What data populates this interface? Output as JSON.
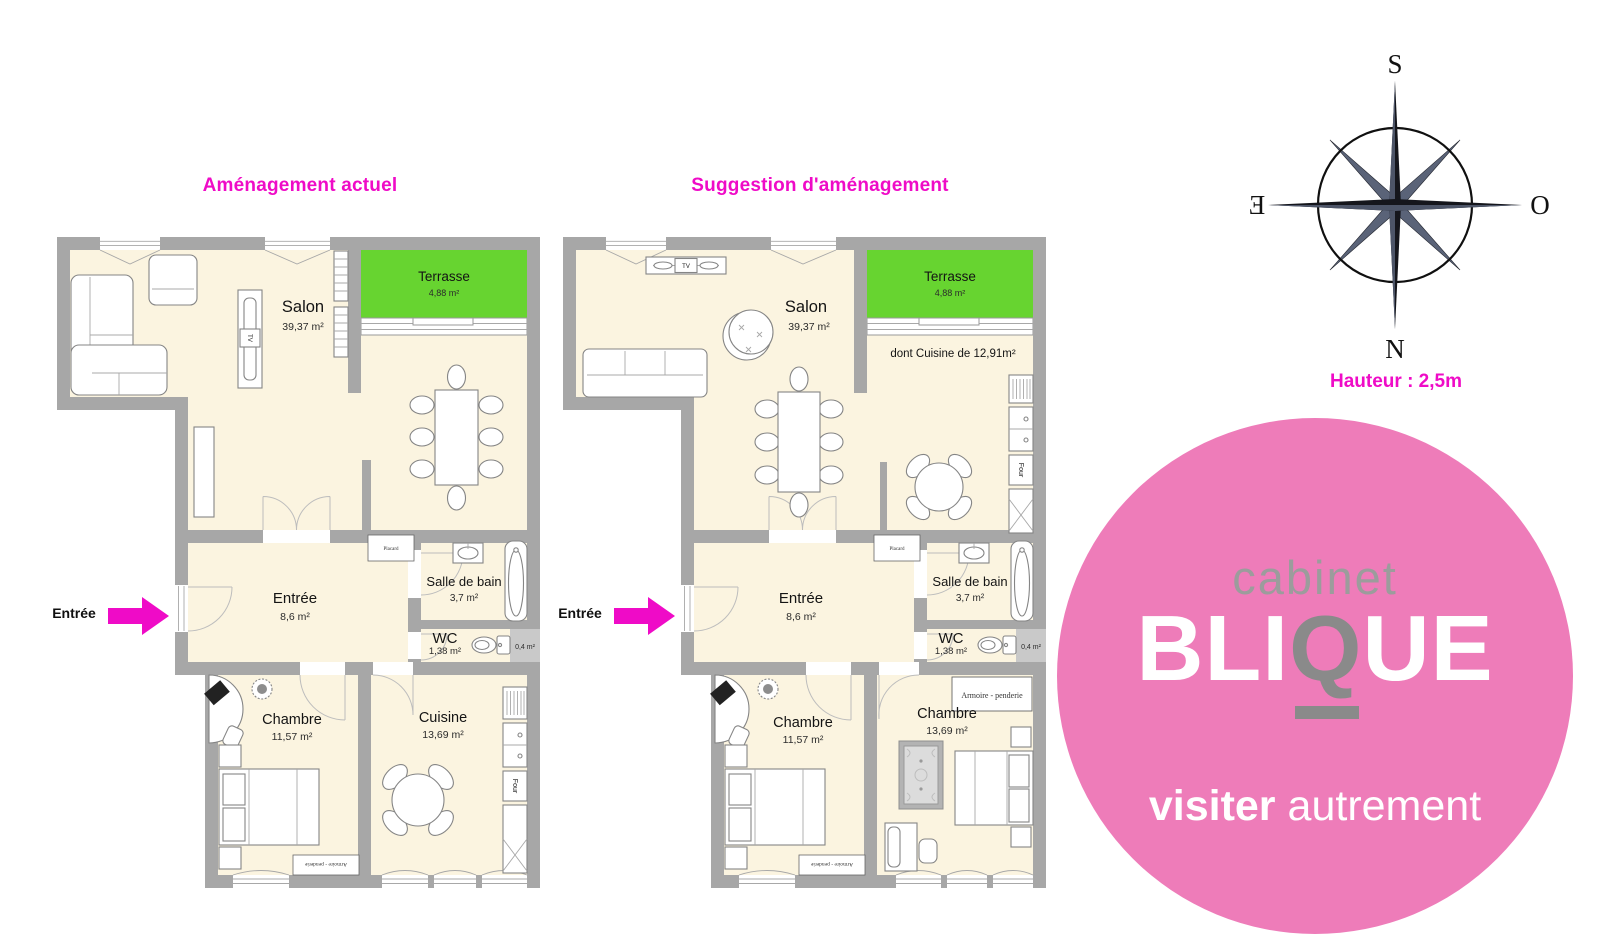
{
  "titles": {
    "left": "Aménagement actuel",
    "right": "Suggestion d'aménagement"
  },
  "entry_label": "Entrée",
  "plans": {
    "left": {
      "salon": {
        "name": "Salon",
        "area": "39,37 m²"
      },
      "terrasse": {
        "name": "Terrasse",
        "area": "4,88 m²"
      },
      "entree": {
        "name": "Entrée",
        "area": "8,6 m²"
      },
      "salle_de_bain": {
        "name": "Salle de bain",
        "area": "3,7 m²"
      },
      "wc": {
        "name": "WC",
        "area": "1,38 m²"
      },
      "closet_area": "0,4 m²",
      "placard": "Placard",
      "chambre": {
        "name": "Chambre",
        "area": "11,57 m²"
      },
      "cuisine": {
        "name": "Cuisine",
        "area": "13,69 m²"
      },
      "armoire": "Armoire - penderie",
      "four": "Four",
      "tv": "TV"
    },
    "right": {
      "salon": {
        "name": "Salon",
        "area": "39,37 m²"
      },
      "terrasse": {
        "name": "Terrasse",
        "area": "4,88 m²"
      },
      "kitchen_note": "dont Cuisine de 12,91m²",
      "entree": {
        "name": "Entrée",
        "area": "8,6 m²"
      },
      "salle_de_bain": {
        "name": "Salle de bain",
        "area": "3,7 m²"
      },
      "wc": {
        "name": "WC",
        "area": "1,38 m²"
      },
      "closet_area": "0,4 m²",
      "placard": "Placard",
      "chambre": {
        "name": "Chambre",
        "area": "11,57 m²"
      },
      "chambre2": {
        "name": "Chambre",
        "area": "13,69 m²"
      },
      "armoire": "Armoire - penderie",
      "armoire2": "Armoire - penderie",
      "four": "Four",
      "tv": "TV"
    }
  },
  "compass": {
    "top": "S",
    "bottom": "N",
    "left": "E",
    "right": "O"
  },
  "height_note": "Hauteur : 2,5m",
  "logo": {
    "line1": "cabinet",
    "brand_pre": "BLI",
    "brand_q": "Q",
    "brand_post": "UE",
    "tagline_bold": "visiter",
    "tagline_light": "autrement"
  },
  "colors": {
    "magenta": "#ef0bc7",
    "pink": "#ee7cb9",
    "green": "#67d430",
    "wall": "#a7a7a7",
    "floor": "#fbf4e0",
    "logo_gray": "#9c9c9c"
  }
}
